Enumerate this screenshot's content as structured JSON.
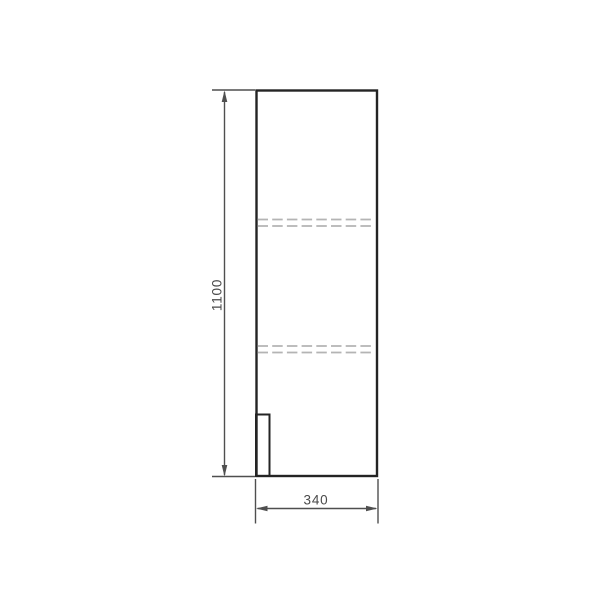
{
  "drawing": {
    "dimensions": {
      "height": {
        "label": "1100"
      },
      "width": {
        "label": "340"
      }
    },
    "colors": {
      "background": "#ffffff",
      "outline": "#242424",
      "dimension": "#4f4f4f",
      "shelf_dashed": "#b4b4b4"
    }
  }
}
